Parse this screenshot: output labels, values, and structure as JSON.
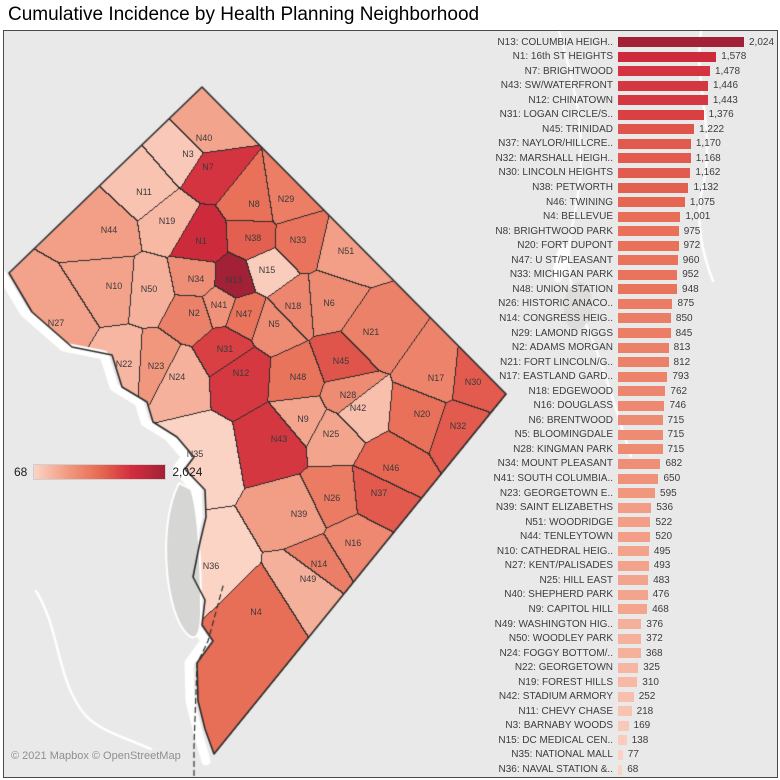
{
  "title": "Cumulative Incidence by Health Planning Neighborhood",
  "attribution": "© 2021 Mapbox © OpenStreetMap",
  "legend": {
    "min_label": "68",
    "max_label": "2,024"
  },
  "colors": {
    "ramp": [
      [
        0,
        "#fbd4c6"
      ],
      [
        0.25,
        "#f29b82"
      ],
      [
        0.5,
        "#e76a53"
      ],
      [
        0.75,
        "#d12c3d"
      ],
      [
        1,
        "#a32136"
      ]
    ],
    "map_background": "#e9e9e9",
    "region_border": "#2b2b2b",
    "water_gray": "#d6d6d4",
    "road_white": "#ffffff",
    "text_dark": "#3a3a3a",
    "attribution_gray": "#8f8f8f"
  },
  "chart_data": {
    "type": "bar",
    "orientation": "horizontal",
    "title": "Cumulative Incidence by Health Planning Neighborhood",
    "xlim": [
      0,
      2024
    ],
    "color_scale": {
      "min": 68,
      "max": 2024,
      "min_label": "68",
      "max_label": "2,024"
    },
    "categories": [
      "N13: COLUMBIA HEIGH..",
      "N1: 16th ST HEIGHTS",
      "N7: BRIGHTWOOD",
      "N43: SW/WATERFRONT",
      "N12: CHINATOWN",
      "N31: LOGAN CIRCLE/S..",
      "N45: TRINIDAD",
      "N37: NAYLOR/HILLCRE..",
      "N32: MARSHALL HEIGH..",
      "N30: LINCOLN HEIGHTS",
      "N38: PETWORTH",
      "N46: TWINING",
      "N4: BELLEVUE",
      "N8: BRIGHTWOOD PARK",
      "N20: FORT DUPONT",
      "N47: U ST/PLEASANT",
      "N33: MICHIGAN PARK",
      "N48: UNION STATION",
      "N26: HISTORIC ANACO..",
      "N14: CONGRESS HEIG..",
      "N29: LAMOND RIGGS",
      "N2: ADAMS MORGAN",
      "N21: FORT LINCOLN/G..",
      "N17: EASTLAND GARD..",
      "N18: EDGEWOOD",
      "N16: DOUGLASS",
      "N6: BRENTWOOD",
      "N5: BLOOMINGDALE",
      "N28: KINGMAN PARK",
      "N34: MOUNT PLEASANT",
      "N41: SOUTH COLUMBIA..",
      "N23: GEORGETOWN E..",
      "N39: SAINT ELIZABETHS",
      "N51: WOODRIDGE",
      "N44: TENLEYTOWN",
      "N10: CATHEDRAL HEIG..",
      "N27: KENT/PALISADES",
      "N25: HILL EAST",
      "N40: SHEPHERD PARK",
      "N9: CAPITOL HILL",
      "N49: WASHINGTON HIG..",
      "N50: WOODLEY PARK",
      "N24: FOGGY BOTTOM/..",
      "N22: GEORGETOWN",
      "N19: FOREST HILLS",
      "N42: STADIUM ARMORY",
      "N11: CHEVY CHASE",
      "N3: BARNABY WOODS",
      "N15: DC MEDICAL CEN..",
      "N35: NATIONAL MALL",
      "N36: NAVAL STATION &.."
    ],
    "values": [
      2024,
      1578,
      1478,
      1446,
      1443,
      1376,
      1222,
      1170,
      1168,
      1162,
      1132,
      1075,
      1001,
      975,
      972,
      960,
      952,
      948,
      875,
      850,
      845,
      813,
      812,
      793,
      762,
      746,
      715,
      715,
      715,
      682,
      650,
      595,
      536,
      522,
      520,
      495,
      493,
      483,
      476,
      468,
      376,
      372,
      368,
      325,
      310,
      252,
      218,
      169,
      138,
      77,
      68
    ]
  },
  "map": {
    "regions": [
      {
        "id": "N1",
        "label": "N1",
        "x": 200,
        "y": 240
      },
      {
        "id": "N2",
        "label": "N2",
        "x": 193,
        "y": 312
      },
      {
        "id": "N3",
        "label": "N3",
        "x": 187,
        "y": 153
      },
      {
        "id": "N4",
        "label": "N4",
        "x": 255,
        "y": 611
      },
      {
        "id": "N5",
        "label": "N5",
        "x": 273,
        "y": 323
      },
      {
        "id": "N6",
        "label": "N6",
        "x": 328,
        "y": 302
      },
      {
        "id": "N7",
        "label": "N7",
        "x": 207,
        "y": 166
      },
      {
        "id": "N8",
        "label": "N8",
        "x": 253,
        "y": 203
      },
      {
        "id": "N9",
        "label": "N9",
        "x": 302,
        "y": 418
      },
      {
        "id": "N10",
        "label": "N10",
        "x": 113,
        "y": 285
      },
      {
        "id": "N11",
        "label": "N11",
        "x": 143,
        "y": 191
      },
      {
        "id": "N12",
        "label": "N12",
        "x": 240,
        "y": 372
      },
      {
        "id": "N13",
        "label": "N13",
        "x": 233,
        "y": 279
      },
      {
        "id": "N14",
        "label": "N14",
        "x": 318,
        "y": 563
      },
      {
        "id": "N15",
        "label": "N15",
        "x": 266,
        "y": 269
      },
      {
        "id": "N16",
        "label": "N16",
        "x": 352,
        "y": 542
      },
      {
        "id": "N17",
        "label": "N17",
        "x": 435,
        "y": 377
      },
      {
        "id": "N18",
        "label": "N18",
        "x": 292,
        "y": 305
      },
      {
        "id": "N19",
        "label": "N19",
        "x": 166,
        "y": 220
      },
      {
        "id": "N20",
        "label": "N20",
        "x": 421,
        "y": 413
      },
      {
        "id": "N21",
        "label": "N21",
        "x": 370,
        "y": 331
      },
      {
        "id": "N22",
        "label": "N22",
        "x": 123,
        "y": 363
      },
      {
        "id": "N23",
        "label": "N23",
        "x": 155,
        "y": 365
      },
      {
        "id": "N24",
        "label": "N24",
        "x": 176,
        "y": 376
      },
      {
        "id": "N25",
        "label": "N25",
        "x": 330,
        "y": 433
      },
      {
        "id": "N26",
        "label": "N26",
        "x": 331,
        "y": 497
      },
      {
        "id": "N27",
        "label": "N27",
        "x": 55,
        "y": 322
      },
      {
        "id": "N28",
        "label": "N28",
        "x": 347,
        "y": 394
      },
      {
        "id": "N29",
        "label": "N29",
        "x": 285,
        "y": 198
      },
      {
        "id": "N30",
        "label": "N30",
        "x": 472,
        "y": 381
      },
      {
        "id": "N31",
        "label": "N31",
        "x": 224,
        "y": 348
      },
      {
        "id": "N32",
        "label": "N32",
        "x": 457,
        "y": 425
      },
      {
        "id": "N33",
        "label": "N33",
        "x": 297,
        "y": 239
      },
      {
        "id": "N34",
        "label": "N34",
        "x": 195,
        "y": 278
      },
      {
        "id": "N35",
        "label": "N35",
        "x": 194,
        "y": 453
      },
      {
        "id": "N36",
        "label": "N36",
        "x": 210,
        "y": 565
      },
      {
        "id": "N37",
        "label": "N37",
        "x": 378,
        "y": 492
      },
      {
        "id": "N38",
        "label": "N38",
        "x": 252,
        "y": 237
      },
      {
        "id": "N39",
        "label": "N39",
        "x": 298,
        "y": 513
      },
      {
        "id": "N40",
        "label": "N40",
        "x": 203,
        "y": 137
      },
      {
        "id": "N41",
        "label": "N41",
        "x": 218,
        "y": 304
      },
      {
        "id": "N42",
        "label": "N42",
        "x": 357,
        "y": 407
      },
      {
        "id": "N43",
        "label": "N43",
        "x": 278,
        "y": 438
      },
      {
        "id": "N44",
        "label": "N44",
        "x": 108,
        "y": 229
      },
      {
        "id": "N45",
        "label": "N45",
        "x": 340,
        "y": 360
      },
      {
        "id": "N46",
        "label": "N46",
        "x": 390,
        "y": 467
      },
      {
        "id": "N47",
        "label": "N47",
        "x": 243,
        "y": 313
      },
      {
        "id": "N48",
        "label": "N48",
        "x": 297,
        "y": 376
      },
      {
        "id": "N49",
        "label": "N49",
        "x": 307,
        "y": 578
      },
      {
        "id": "N50",
        "label": "N50",
        "x": 148,
        "y": 288
      },
      {
        "id": "N51",
        "label": "N51",
        "x": 345,
        "y": 250
      }
    ]
  }
}
